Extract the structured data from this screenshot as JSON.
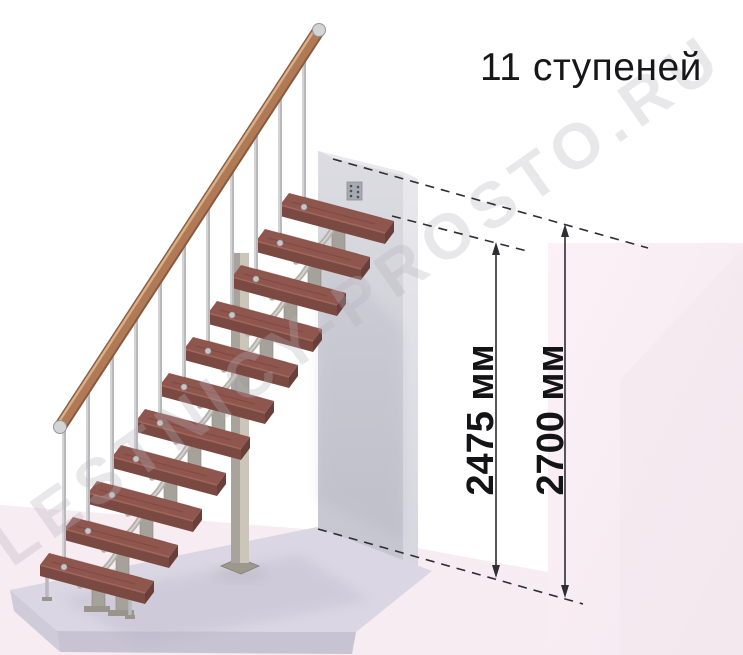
{
  "title": "11 ступеней",
  "watermark": "LESTNICY-PROSTO.RU",
  "dims": [
    {
      "label": "2475 мм",
      "value": 2475
    },
    {
      "label": "2700 мм",
      "value": 2700
    }
  ],
  "diagram": {
    "type": "staircase-side-elevation",
    "steps_count": 11,
    "first_step": {
      "x": 40,
      "y": 556
    },
    "step_dx": 24,
    "step_dy": 36,
    "rail": {
      "x0": 60,
      "y0": 427,
      "x1": 319,
      "y1": 30
    },
    "colors": {
      "tread_top": "#8e564d",
      "tread_front": "#7a4a42",
      "tread_side": "#6a3f39",
      "tread_highlight": "#a5695d",
      "streak": "#6e423b",
      "metal": "#b9b9bd",
      "metal_light": "#e4e4e7",
      "support": "#a6a29b",
      "support_edge": "#8b877f",
      "branch": "#b4b0a9",
      "branch_light": "#d8d5cf",
      "foot": "#9a958c",
      "disc": "#c6c6c9",
      "rail_dark": "#8a5a40",
      "rail_mid": "#b07a56",
      "rail_light": "#e0b98f",
      "cap": "#d4d4d7",
      "annotation": "#2e2e33",
      "text": "#141417"
    }
  }
}
